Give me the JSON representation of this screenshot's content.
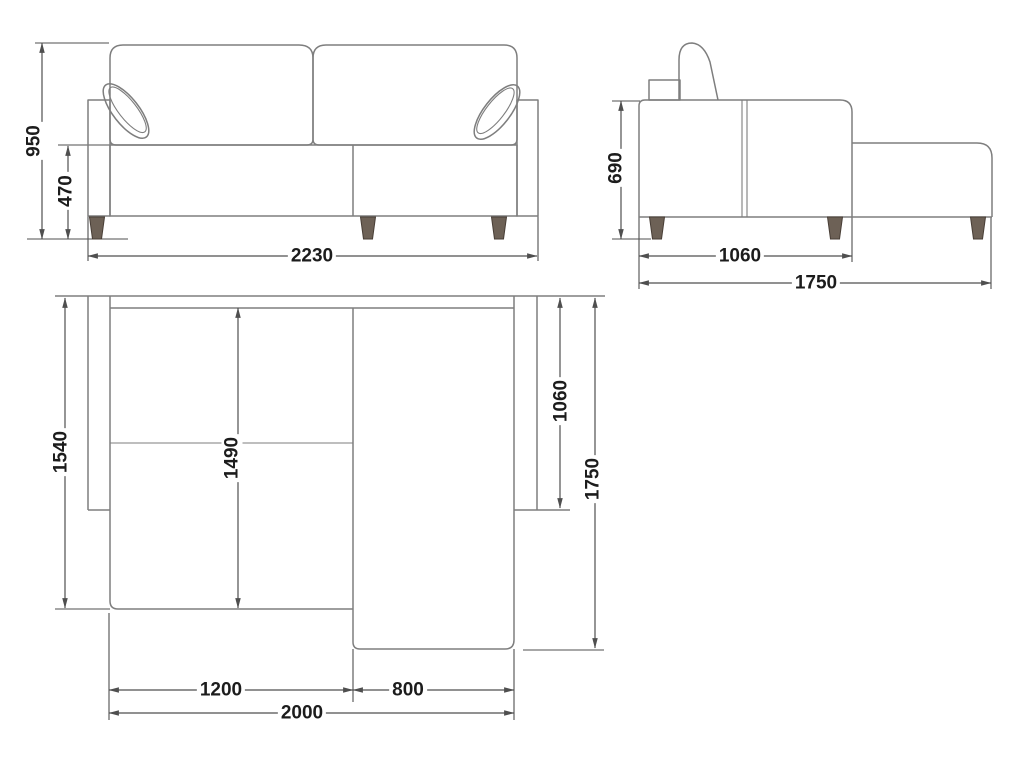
{
  "views": {
    "front": {
      "name": "front elevation",
      "labels": {
        "height": "950",
        "seat_height": "470",
        "width": "2230"
      }
    },
    "side": {
      "name": "side elevation",
      "labels": {
        "height": "690",
        "depth_body": "1060",
        "depth_total": "1750"
      }
    },
    "plan": {
      "name": "top plan",
      "labels": {
        "depth_left": "1540",
        "depth_seat": "1490",
        "depth_body": "1060",
        "depth_total": "1750",
        "width_seat": "1200",
        "width_chaise": "800",
        "width_total": "2000"
      }
    }
  },
  "colors": {
    "background": "#ffffff",
    "furniture_outline": "#7e7e7e",
    "dimension_lines": "#4f4f4f",
    "text": "#1c1c1c",
    "leg_fill": "#6d6156",
    "leg_stroke": "#483e36"
  }
}
